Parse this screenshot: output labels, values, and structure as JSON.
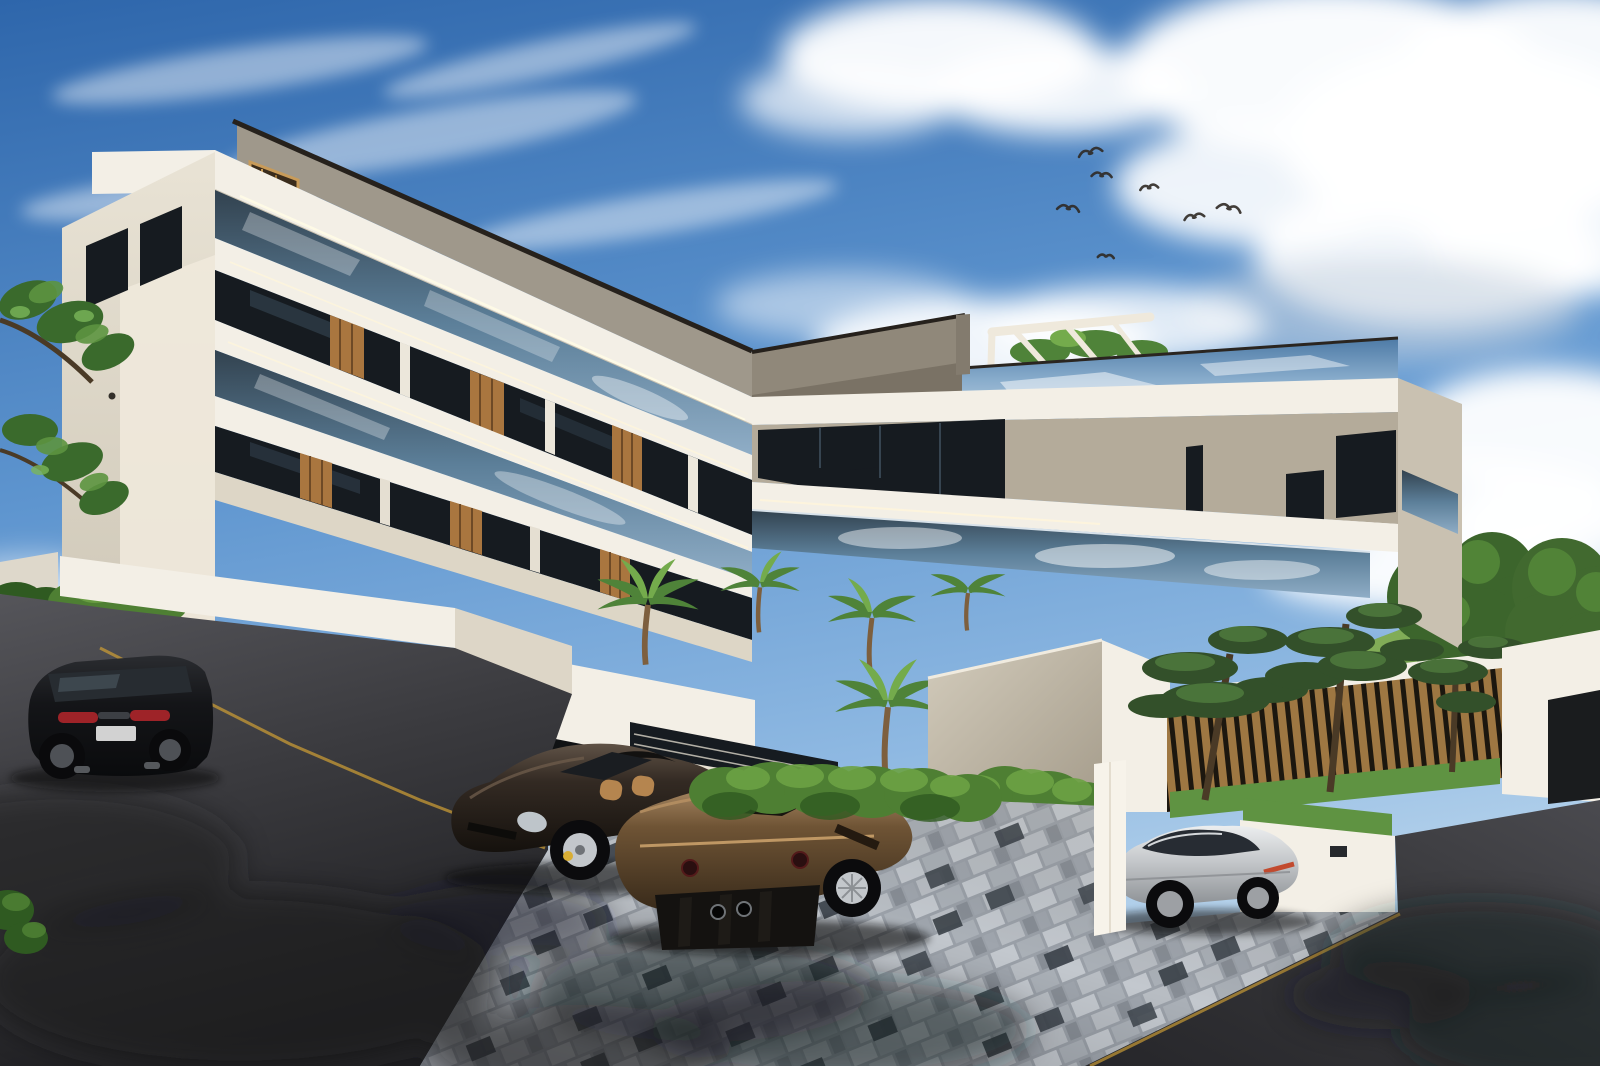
{
  "scene": {
    "type": "architectural-exterior-render",
    "description": "Daytime photorealistic rendering of a modern multi-storey white apartment building with glass balconies, terraced planters, palm trees and four luxury cars parked on asphalt and checkered pavers",
    "sky": {
      "condition": "blue sky with scattered white cumulus clouds and thin wisps",
      "birds_count": 7
    },
    "building": {
      "style": "contemporary white concrete with continuous glass balustrades and warm wood slat accents",
      "wings": 2,
      "visible_floors": 4,
      "features": [
        "chevron shaped balcony bands meeting at inner corner",
        "grey penthouse parapet",
        "rooftop pergola frame",
        "LED cove light lines on fascias",
        "dark recessed window bands",
        "wood slat balcony panels"
      ]
    },
    "vehicles": [
      {
        "name": "dark-suv",
        "body_color_key": "car_suv",
        "location": "left asphalt driveway, rear view"
      },
      {
        "name": "dark-brown-targa-sports-car",
        "body_color_key": "car_porsche",
        "location": "center pavers, front three-quarter view, tan interior, yellow brake calipers"
      },
      {
        "name": "bronze-sports-coupe",
        "body_color_key": "car_bronze",
        "location": "center pavers, rear three-quarter view"
      },
      {
        "name": "silver-sedan",
        "body_color_key": "car_silver",
        "location": "right parking nook behind white wall"
      }
    ],
    "vegetation": [
      "box hedges on stepped white planter walls",
      "palm trees in front courtyard",
      "rooftop palm fronds",
      "three niwaki bonsai trees by wooden slat fence",
      "two large leafy trees on grass hill right",
      "overhanging branches upper left"
    ],
    "ground": {
      "surfaces": [
        "dark asphalt road left and bottom right",
        "grey checkered block pavers parking area center",
        "yellow curb edge lines"
      ],
      "shadows": "soft tree and palm shadows across pavement"
    }
  },
  "palette": {
    "sky_top": "#2e66ab",
    "sky_mid": "#5e95cf",
    "sky_low": "#a8c9e8",
    "cloud_white": "#ffffff",
    "cloud_shadow": "#c7d2df",
    "building_white": "#f3efe6",
    "building_shade": "#ddd6c6",
    "building_cream": "#e9e3d3",
    "parapet_grey": "#90887a",
    "roof_edge": "#26211c",
    "stucco_warm": "#b4ab9a",
    "window_dark": "#161b20",
    "glass_dark": "#2b3845",
    "glass_sky": "#6f95b8",
    "wood": "#a9763f",
    "fence_wood": "#b5884c",
    "fence_gap": "#17130e",
    "hedge": "#4e7f33",
    "hedge_light": "#6ca244",
    "hedge_dark": "#2f5a21",
    "palm": "#4f8339",
    "palm_light": "#74ab4c",
    "tree": "#3c652c",
    "tree_light": "#558a3a",
    "lawn": "#5f9342",
    "hill": "#6f9b4a",
    "asphalt": "#3e3e42",
    "asphalt_shadow": "#232326",
    "asphalt_light": "#54545a",
    "paver_light": "#c3c8ce",
    "paver_mid": "#a0a7af",
    "paver_dark": "#3e454d",
    "curb_yellow": "#c79a36",
    "car_suv": "#141518",
    "car_porsche": "#2e2620",
    "car_bronze": "#6f5435",
    "car_bronze_light": "#a5845c",
    "car_silver": "#ccced1",
    "taillight_red": "#9e2328",
    "interior_tan": "#b5854f",
    "caliper_yellow": "#d9ae34",
    "rim_silver": "#c3c7cb"
  }
}
